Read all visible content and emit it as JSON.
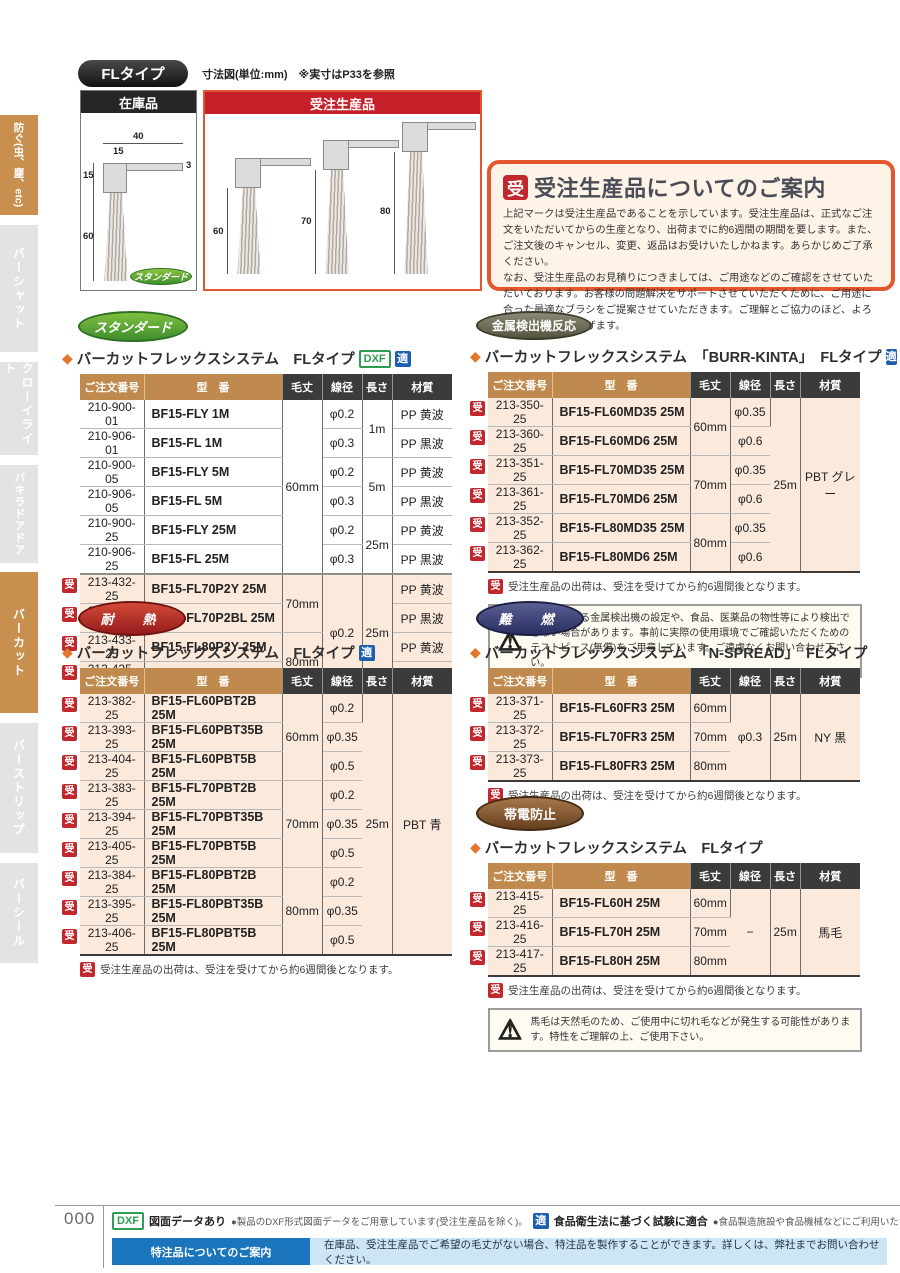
{
  "sidebar": {
    "items": [
      {
        "label": "防ぐ(虫、塵、etc)"
      },
      {
        "label": "バーシャット"
      },
      {
        "label": "クローイライト"
      },
      {
        "label": "バキラドアドア"
      },
      {
        "label": "バーカット"
      },
      {
        "label": "バーストリップ"
      },
      {
        "label": "バーシール"
      }
    ]
  },
  "top": {
    "type_badge": "FLタイプ",
    "caption": "寸法図(単位:mm)　※実寸はP33を参照",
    "stock_box": {
      "title": "在庫品",
      "badge": "スタンダード",
      "dims": {
        "top_w": "40",
        "inner_w": "15",
        "thickness": "3",
        "block_h": "15",
        "brush_h": "60"
      }
    },
    "order_box": {
      "title": "受注生産品",
      "heights": [
        "60",
        "70",
        "80"
      ]
    },
    "info_box": {
      "badge": "受",
      "title": "受注生産品についてのご案内",
      "body1": "上記マークは受注生産品であることを示しています。受注生産品は、正式なご注文をいただいてからの生産となり、出荷までに約6週間の期間を要します。また、ご注文後のキャンセル、変更、返品はお受けいたしかねます。あらかじめご了承ください。",
      "body2": "なお、受注生産品のお見積りにつきましては、ご用途などのご確認をさせていただいております。お客様の問題解決をサポートさせていただくために、ご用途に合った最適なブラシをご提案させていただきます。ご理解とご協力のほど、よろしくお願い申し上げます。"
    }
  },
  "common": {
    "ju": "受",
    "diamond": "◆",
    "note": "受注生産品の出荷は、受注を受けてから約6週間後となります。"
  },
  "colors": {
    "accent_orange": "#e4572e",
    "table_header_orange": "#c08a4e",
    "table_header_dark": "#3b3b3b",
    "order_made_red": "#c1272d",
    "beige_row": "#fbeadc",
    "teki_blue": "#1b5fae",
    "dxf_green": "#2e9e53",
    "footer_blue": "#1a75bc"
  },
  "sections": {
    "standard": {
      "badge": "スタンダード",
      "heading": "バーカットフレックスシステム　FLタイプ",
      "marks": [
        "DXF",
        "適"
      ],
      "table": {
        "headers": [
          "ご注文番号",
          "型　番",
          "毛丈",
          "線径",
          "長さ",
          "材質"
        ],
        "rows": [
          {
            "ju": false,
            "w": true,
            "c": [
              [
                "210-900-01",
                1
              ],
              [
                "BF15-FLY 1M",
                1
              ],
              [
                "60mm",
                6
              ],
              [
                "φ0.2",
                1
              ],
              [
                "1m",
                2
              ],
              [
                "PP 黄波",
                1
              ]
            ]
          },
          {
            "ju": false,
            "w": true,
            "c": [
              [
                "210-906-01",
                1
              ],
              [
                "BF15-FL 1M",
                1
              ],
              null,
              [
                "φ0.3",
                1
              ],
              null,
              [
                "PP 黒波",
                1
              ]
            ]
          },
          {
            "ju": false,
            "w": true,
            "c": [
              [
                "210-900-05",
                1
              ],
              [
                "BF15-FLY 5M",
                1
              ],
              null,
              [
                "φ0.2",
                1
              ],
              [
                "5m",
                2
              ],
              [
                "PP 黄波",
                1
              ]
            ]
          },
          {
            "ju": false,
            "w": true,
            "c": [
              [
                "210-906-05",
                1
              ],
              [
                "BF15-FL 5M",
                1
              ],
              null,
              [
                "φ0.3",
                1
              ],
              null,
              [
                "PP 黒波",
                1
              ]
            ]
          },
          {
            "ju": false,
            "w": true,
            "c": [
              [
                "210-900-25",
                1
              ],
              [
                "BF15-FLY 25M",
                1
              ],
              null,
              [
                "φ0.2",
                1
              ],
              [
                "25m",
                2
              ],
              [
                "PP 黄波",
                1
              ]
            ]
          },
          {
            "ju": false,
            "w": true,
            "c": [
              [
                "210-906-25",
                1
              ],
              [
                "BF15-FL 25M",
                1
              ],
              null,
              [
                "φ0.3",
                1
              ],
              null,
              [
                "PP 黒波",
                1
              ]
            ]
          },
          {
            "ju": true,
            "w": false,
            "sep": true,
            "c": [
              [
                "213-432-25",
                1
              ],
              [
                "BF15-FL70P2Y 25M",
                1
              ],
              [
                "70mm",
                2
              ],
              [
                "φ0.2",
                4
              ],
              [
                "25m",
                4
              ],
              [
                "PP 黄波",
                1
              ]
            ]
          },
          {
            "ju": true,
            "w": false,
            "c": [
              [
                "213-424-25",
                1
              ],
              [
                "BF15-FL70P2BL 25M",
                1
              ],
              null,
              null,
              null,
              [
                "PP 黒波",
                1
              ]
            ]
          },
          {
            "ju": true,
            "w": false,
            "c": [
              [
                "213-433-25",
                1
              ],
              [
                "BF15-FL80P2Y 25M",
                1
              ],
              [
                "80mm",
                2
              ],
              null,
              null,
              [
                "PP 黄波",
                1
              ]
            ]
          },
          {
            "ju": true,
            "w": false,
            "c": [
              [
                "213-425-25",
                1
              ],
              [
                "BF15-FL80P2BL 25M",
                1
              ],
              null,
              null,
              null,
              [
                "PP 黒波",
                1
              ]
            ]
          }
        ]
      }
    },
    "metal": {
      "badge": "金属検出機反応",
      "heading": "バーカットフレックスシステム　「BURR-KINTA」　FLタイプ",
      "marks": [
        "適"
      ],
      "warning": "ご使用される金属検出機の設定や、食品、医薬品の物性等により検出できない場合があります。事前に実際の使用環境でご確認いただくためのテストピース(無償)をご用意しています。ご遠慮なくお問い合わせ下さい。",
      "table": {
        "headers": [
          "ご注文番号",
          "型　番",
          "毛丈",
          "線径",
          "長さ",
          "材質"
        ],
        "rows": [
          {
            "ju": true,
            "c": [
              [
                "213-350-25",
                1
              ],
              [
                "BF15-FL60MD35 25M",
                1
              ],
              [
                "60mm",
                2
              ],
              [
                "φ0.35",
                1
              ],
              [
                "25m",
                6
              ],
              [
                "PBT グレー",
                6
              ]
            ]
          },
          {
            "ju": true,
            "c": [
              [
                "213-360-25",
                1
              ],
              [
                "BF15-FL60MD6 25M",
                1
              ],
              null,
              [
                "φ0.6",
                1
              ],
              null,
              null
            ]
          },
          {
            "ju": true,
            "c": [
              [
                "213-351-25",
                1
              ],
              [
                "BF15-FL70MD35 25M",
                1
              ],
              [
                "70mm",
                2
              ],
              [
                "φ0.35",
                1
              ],
              null,
              null
            ]
          },
          {
            "ju": true,
            "c": [
              [
                "213-361-25",
                1
              ],
              [
                "BF15-FL70MD6 25M",
                1
              ],
              null,
              [
                "φ0.6",
                1
              ],
              null,
              null
            ]
          },
          {
            "ju": true,
            "c": [
              [
                "213-352-25",
                1
              ],
              [
                "BF15-FL80MD35 25M",
                1
              ],
              [
                "80mm",
                2
              ],
              [
                "φ0.35",
                1
              ],
              null,
              null
            ]
          },
          {
            "ju": true,
            "c": [
              [
                "213-362-25",
                1
              ],
              [
                "BF15-FL80MD6 25M",
                1
              ],
              null,
              [
                "φ0.6",
                1
              ],
              null,
              null
            ]
          }
        ]
      }
    },
    "heat": {
      "badge": "耐　熱",
      "heading": "バーカットフレックスシステム　FLタイプ",
      "marks": [
        "適"
      ],
      "table": {
        "headers": [
          "ご注文番号",
          "型　番",
          "毛丈",
          "線径",
          "長さ",
          "材質"
        ],
        "rows": [
          {
            "ju": true,
            "c": [
              [
                "213-382-25",
                1
              ],
              [
                "BF15-FL60PBT2B 25M",
                1
              ],
              [
                "60mm",
                3
              ],
              [
                "φ0.2",
                1
              ],
              [
                "25m",
                9
              ],
              [
                "PBT 青",
                9
              ]
            ]
          },
          {
            "ju": true,
            "c": [
              [
                "213-393-25",
                1
              ],
              [
                "BF15-FL60PBT35B 25M",
                1
              ],
              null,
              [
                "φ0.35",
                1
              ],
              null,
              null
            ]
          },
          {
            "ju": true,
            "c": [
              [
                "213-404-25",
                1
              ],
              [
                "BF15-FL60PBT5B 25M",
                1
              ],
              null,
              [
                "φ0.5",
                1
              ],
              null,
              null
            ]
          },
          {
            "ju": true,
            "c": [
              [
                "213-383-25",
                1
              ],
              [
                "BF15-FL70PBT2B 25M",
                1
              ],
              [
                "70mm",
                3
              ],
              [
                "φ0.2",
                1
              ],
              null,
              null
            ]
          },
          {
            "ju": true,
            "c": [
              [
                "213-394-25",
                1
              ],
              [
                "BF15-FL70PBT35B 25M",
                1
              ],
              null,
              [
                "φ0.35",
                1
              ],
              null,
              null
            ]
          },
          {
            "ju": true,
            "c": [
              [
                "213-405-25",
                1
              ],
              [
                "BF15-FL70PBT5B 25M",
                1
              ],
              null,
              [
                "φ0.5",
                1
              ],
              null,
              null
            ]
          },
          {
            "ju": true,
            "c": [
              [
                "213-384-25",
                1
              ],
              [
                "BF15-FL80PBT2B 25M",
                1
              ],
              [
                "80mm",
                3
              ],
              [
                "φ0.2",
                1
              ],
              null,
              null
            ]
          },
          {
            "ju": true,
            "c": [
              [
                "213-395-25",
                1
              ],
              [
                "BF15-FL80PBT35B 25M",
                1
              ],
              null,
              [
                "φ0.35",
                1
              ],
              null,
              null
            ]
          },
          {
            "ju": true,
            "c": [
              [
                "213-406-25",
                1
              ],
              [
                "BF15-FL80PBT5B 25M",
                1
              ],
              null,
              [
                "φ0.5",
                1
              ],
              null,
              null
            ]
          }
        ]
      }
    },
    "flame": {
      "badge": "難　燃",
      "heading": "バーカットフレックスシステム　「N-SPREAD」　FLタイプ",
      "marks": [],
      "table": {
        "headers": [
          "ご注文番号",
          "型　番",
          "毛丈",
          "線径",
          "長さ",
          "材質"
        ],
        "rows": [
          {
            "ju": true,
            "c": [
              [
                "213-371-25",
                1
              ],
              [
                "BF15-FL60FR3 25M",
                1
              ],
              [
                "60mm",
                1
              ],
              [
                "φ0.3",
                3
              ],
              [
                "25m",
                3
              ],
              [
                "NY 黒",
                3
              ]
            ]
          },
          {
            "ju": true,
            "c": [
              [
                "213-372-25",
                1
              ],
              [
                "BF15-FL70FR3 25M",
                1
              ],
              [
                "70mm",
                1
              ],
              null,
              null,
              null
            ]
          },
          {
            "ju": true,
            "c": [
              [
                "213-373-25",
                1
              ],
              [
                "BF15-FL80FR3 25M",
                1
              ],
              [
                "80mm",
                1
              ],
              null,
              null,
              null
            ]
          }
        ]
      }
    },
    "anti": {
      "badge": "帯電防止",
      "heading": "バーカットフレックスシステム　FLタイプ",
      "marks": [],
      "warning": "馬毛は天然毛のため、ご使用中に切れ毛などが発生する可能性があります。特性をご理解の上、ご使用下さい。",
      "table": {
        "headers": [
          "ご注文番号",
          "型　番",
          "毛丈",
          "線径",
          "長さ",
          "材質"
        ],
        "rows": [
          {
            "ju": true,
            "c": [
              [
                "213-415-25",
                1
              ],
              [
                "BF15-FL60H 25M",
                1
              ],
              [
                "60mm",
                1
              ],
              [
                "−",
                3
              ],
              [
                "25m",
                3
              ],
              [
                "馬毛",
                3
              ]
            ]
          },
          {
            "ju": true,
            "c": [
              [
                "213-416-25",
                1
              ],
              [
                "BF15-FL70H 25M",
                1
              ],
              [
                "70mm",
                1
              ],
              null,
              null,
              null
            ]
          },
          {
            "ju": true,
            "c": [
              [
                "213-417-25",
                1
              ],
              [
                "BF15-FL80H 25M",
                1
              ],
              [
                "80mm",
                1
              ],
              null,
              null,
              null
            ]
          }
        ]
      }
    }
  },
  "footer": {
    "page_number": "000",
    "dxf_badge": "DXF",
    "dxf_title": "図面データあり",
    "dxf_desc": "●製品のDXF形式図面データをご用意しています(受注生産品を除く)。",
    "teki_badge": "適",
    "teki_title": "食品衛生法に基づく試験に適合",
    "teki_desc": "●食品製造施設や食品機械などにご利用いただけます。",
    "custom_label": "特注品についてのご案内",
    "custom_text": "在庫品、受注生産品でご希望の毛丈がない場合、特注品を製作することができます。詳しくは、弊社までお問い合わせください。"
  }
}
